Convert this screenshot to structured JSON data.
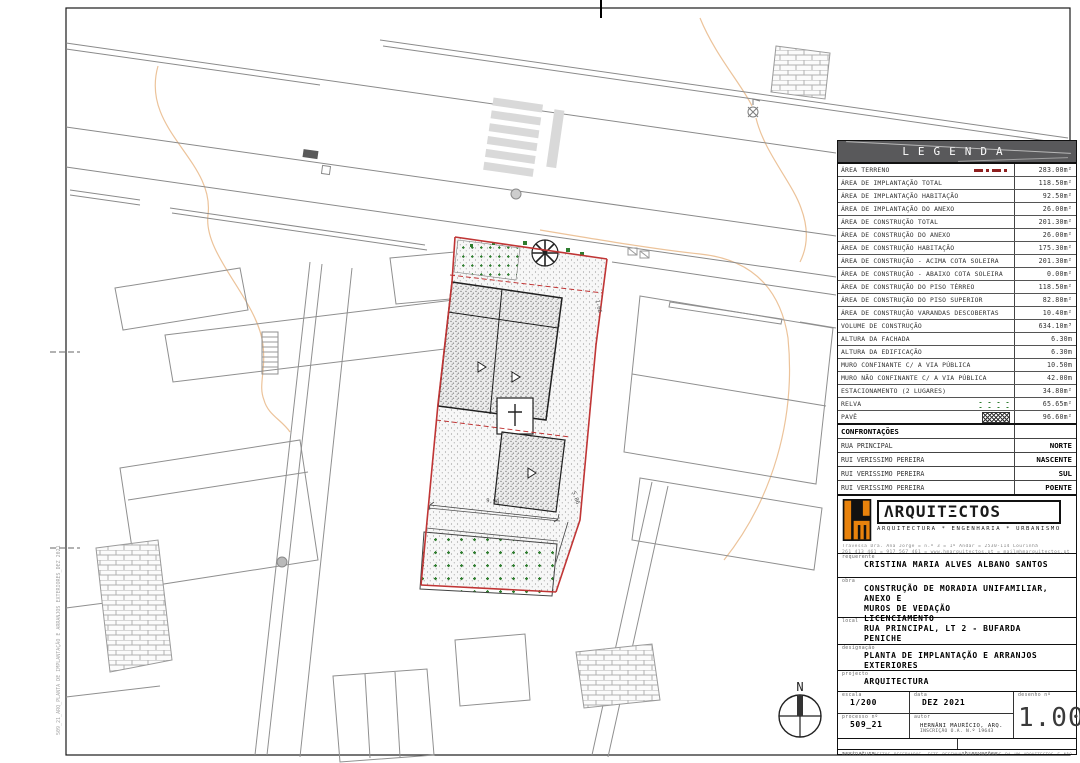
{
  "legend": {
    "title": "LEGENDA",
    "rows": [
      {
        "label": "ÁREA TERRENO",
        "value": "283.00m²",
        "symbol": "red-dash"
      },
      {
        "label": "ÁREA DE IMPLANTAÇÃO TOTAL",
        "value": "118.50m²"
      },
      {
        "label": "ÁREA DE IMPLANTAÇÃO HABITAÇÃO",
        "value": "92.50m²"
      },
      {
        "label": "ÁREA DE IMPLANTAÇÃO DO ANEXO",
        "value": "26.00m²"
      },
      {
        "label": "ÁREA DE CONSTRUÇÃO TOTAL",
        "value": "201.30m²"
      },
      {
        "label": "ÁREA DE CONSTRUÇÃO DO ANEXO",
        "value": "26.00m²"
      },
      {
        "label": "ÁREA DE CONSTRUÇÃO HABITAÇÃO",
        "value": "175.30m²"
      },
      {
        "label": "ÁREA DE CONSTRUÇÃO - ACIMA COTA SOLEIRA",
        "value": "201.30m²"
      },
      {
        "label": "ÁREA DE CONSTRUÇÃO - ABAIXO COTA SOLEIRA",
        "value": "0.00m²"
      },
      {
        "label": "ÁREA DE CONSTRUÇÃO DO PISO TÉRREO",
        "value": "118.50m²"
      },
      {
        "label": "ÁREA DE CONSTRUÇÃO DO PISO SUPERIOR",
        "value": "82.80m²"
      },
      {
        "label": "ÁREA DE CONSTRUÇÃO VARANDAS DESCOBERTAS",
        "value": "10.40m²"
      },
      {
        "label": "VOLUME DE CONSTRUÇÃO",
        "value": "634.10m³"
      },
      {
        "label": "ALTURA DA FACHADA",
        "value": "6.30m"
      },
      {
        "label": "ALTURA DA EDIFICAÇÃO",
        "value": "6.30m"
      },
      {
        "label": "MURO CONFINANTE C/ A VIA PÚBLICA",
        "value": "10.50m"
      },
      {
        "label": "MURO NÃO CONFINANTE C/ A VIA PÚBLICA",
        "value": "42.00m"
      },
      {
        "label": "ESTACIONAMENTO (2 LUGARES)",
        "value": "34.80m²"
      },
      {
        "label": "RELVA",
        "value": "65.65m²",
        "symbol": "grass"
      },
      {
        "label": "PAVÊ",
        "value": "96.60m²",
        "symbol": "pave"
      }
    ]
  },
  "confrontacoes": {
    "title": "CONFRONTAÇÕES",
    "rows": [
      {
        "label": "RUA PRINCIPAL",
        "value": "NORTE"
      },
      {
        "label": "RUI VERISSIMO PEREIRA",
        "value": "NASCENTE"
      },
      {
        "label": "RUI VERISSIMO PEREIRA",
        "value": "SUL"
      },
      {
        "label": "RUI VERISSIMO PEREIRA",
        "value": "POENTE"
      }
    ]
  },
  "firm": {
    "logo_text": "ΛRQUITΞCTOS",
    "tagline": "ARQUITECTURA * ENGENHARIA * URBANISMO",
    "address_line1": "Travessa Dra. Ana Jorge = n.º 3 = 1º Andar = 2530-114 Lourinhã",
    "address_line2": "261 413 461 = 917 567 461 = www.hmarquitectos.pt = mail@hmarquitectos.pt"
  },
  "titleblock": {
    "requerente_label": "requerente",
    "requerente": "CRISTINA MARIA ALVES ALBANO SANTOS",
    "obra_label": "obra",
    "obra_line1": "CONSTRUÇÃO DE MORADIA UNIFAMILIAR, ANEXO E",
    "obra_line2": "MUROS DE VEDAÇÃO",
    "obra_line3": "LICENCIAMENTO",
    "local_label": "local",
    "local_line1": "RUA PRINCIPAL, LT 2 - BUFARDA",
    "local_line2": "PENICHE",
    "designacao_label": "designação",
    "designacao": "PLANTA DE IMPLANTAÇÃO E ARRANJOS EXTERIORES",
    "projecto_label": "projecto",
    "projecto": "ARQUITECTURA",
    "escala_label": "escala",
    "escala": "1/200",
    "data_label": "data",
    "data": "DEZ 2021",
    "desenho_label": "desenho nº",
    "desenho": "1.00",
    "processo_label": "processo nº",
    "processo": "509_21",
    "autor_label": "autor",
    "autor_line1": "HERNÂNI MAURÍCIO, ARQ.",
    "autor_line2": "INSCRIÇÃO O.A. N.º 19643",
    "assinatura_label": "assinatura",
    "observacoes_label": "observações",
    "disclaimer1": "TODOS OS DIREITOS RESERVADOS. ESTE DESENHO É PROPRIEDADE DA HM ARQUITECTOS E NÃO PODE SER REPRODUZIDO, COPIADO OU UTILIZADO NO TODO OU EM PARTE SEM AUTORIZAÇÃO ESCRITA. AS COTAS INDICADAS PREVALECEM SOBRE A MEDIÇÃO DO DESENHO.",
    "disclaimer2": "O EMPREITEIRO DEVERÁ VERIFICAR TODAS AS DIMENSÕES EM OBRA ANTES DO INÍCIO DOS TRABALHOS. QUALQUER DIVERGÊNCIA DEVERÁ SER COMUNICADA AO PROJECTISTA."
  },
  "plan": {
    "north_label": "N",
    "dim1": "9.90",
    "dim2": "5.86",
    "dim3": "1.66",
    "file_path": "509_21_ARQ_PLANTA DE IMPLANTAÇÃO E ARRANJOS EXTERIORES_DEZ 2021"
  },
  "colors": {
    "lot_red": "#c03535",
    "legend_red": "#8f2020",
    "grass_green": "#2f7d2f",
    "contour_orange": "#ecc39a",
    "header_gray": "#59595b",
    "logo_orange": "#e8820c"
  }
}
